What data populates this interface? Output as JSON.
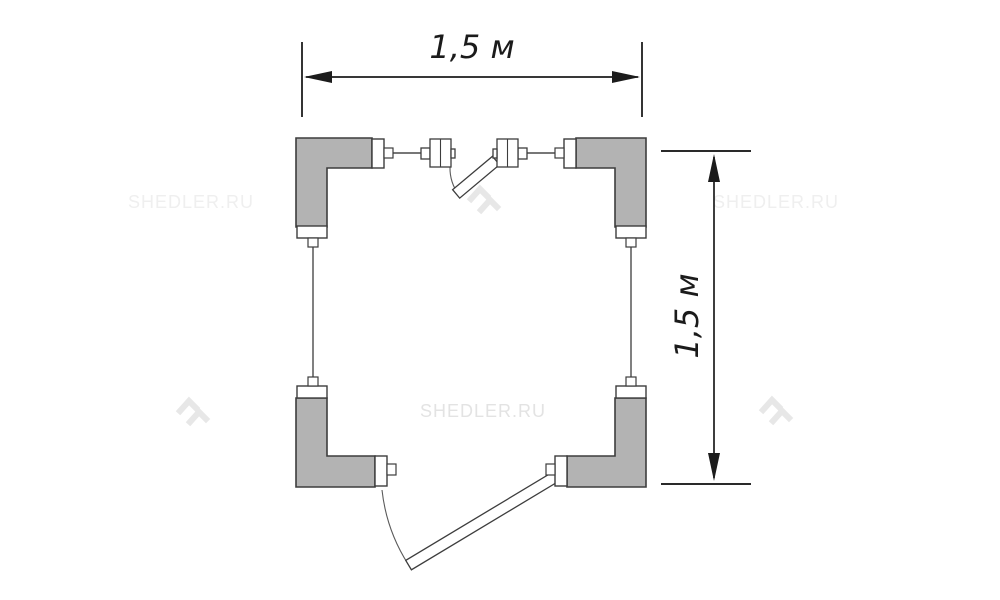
{
  "diagram": {
    "width_dimension": "1,5 м",
    "height_dimension": "1,5 м"
  },
  "watermark": {
    "text": "SHEDLER.RU"
  },
  "colors": {
    "background": "#ffffff",
    "panel_fill": "#b3b3b3",
    "outline": "#3d3d3d",
    "dimension": "#1c1c1c",
    "watermark_text_side": "#efefef",
    "watermark_text_center": "#e3e3e3",
    "watermark_glyph": "#e7e7e7"
  }
}
